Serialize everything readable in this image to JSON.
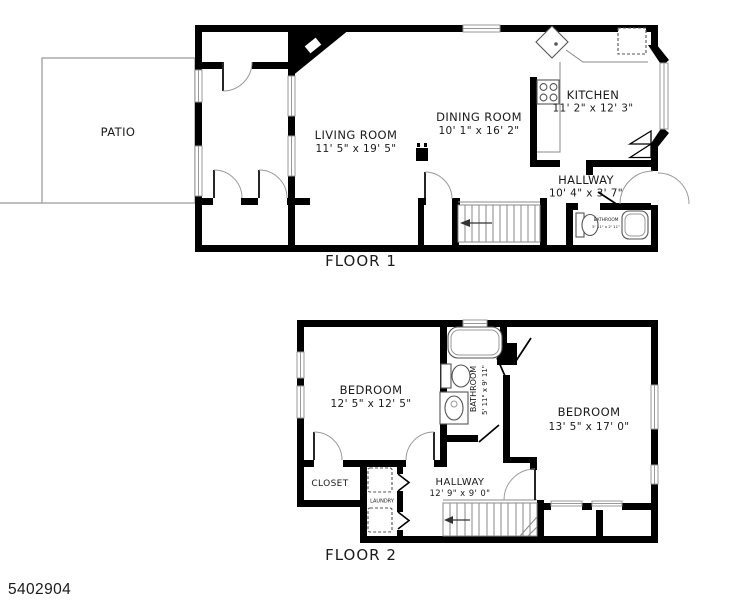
{
  "watermark": "5402904",
  "floor1": {
    "title": "FLOOR 1",
    "patio": {
      "label": "PATIO"
    },
    "living_room": {
      "label": "LIVING ROOM",
      "dims": "11' 5\" x 19' 5\""
    },
    "dining_room": {
      "label": "DINING ROOM",
      "dims": "10' 1\" x 16' 2\""
    },
    "kitchen": {
      "label": "KITCHEN",
      "dims": "11' 2\" x 12' 3\""
    },
    "hallway": {
      "label": "HALLWAY",
      "dims": "10' 4\" x 3' 7\""
    },
    "bathroom": {
      "label": "BATHROOM",
      "dims": "5' 11\" x 2' 11\""
    }
  },
  "floor2": {
    "title": "FLOOR 2",
    "bedroom_left": {
      "label": "BEDROOM",
      "dims": "12' 5\" x 12' 5\""
    },
    "bathroom": {
      "label": "BATHROOM",
      "dims": "5' 11\" x 9' 11\""
    },
    "bedroom_right": {
      "label": "BEDROOM",
      "dims": "13' 5\" x 17' 0\""
    },
    "closet": {
      "label": "CLOSET"
    },
    "laundry": {
      "label": "LAUNDRY"
    },
    "hallway": {
      "label": "HALLWAY",
      "dims": "12' 9\" x 9' 0\""
    }
  },
  "colors": {
    "wall": "#000000",
    "window": "#999999",
    "patio_outline": "#aaaaaa",
    "text": "#1b1b1b",
    "background": "#ffffff"
  }
}
